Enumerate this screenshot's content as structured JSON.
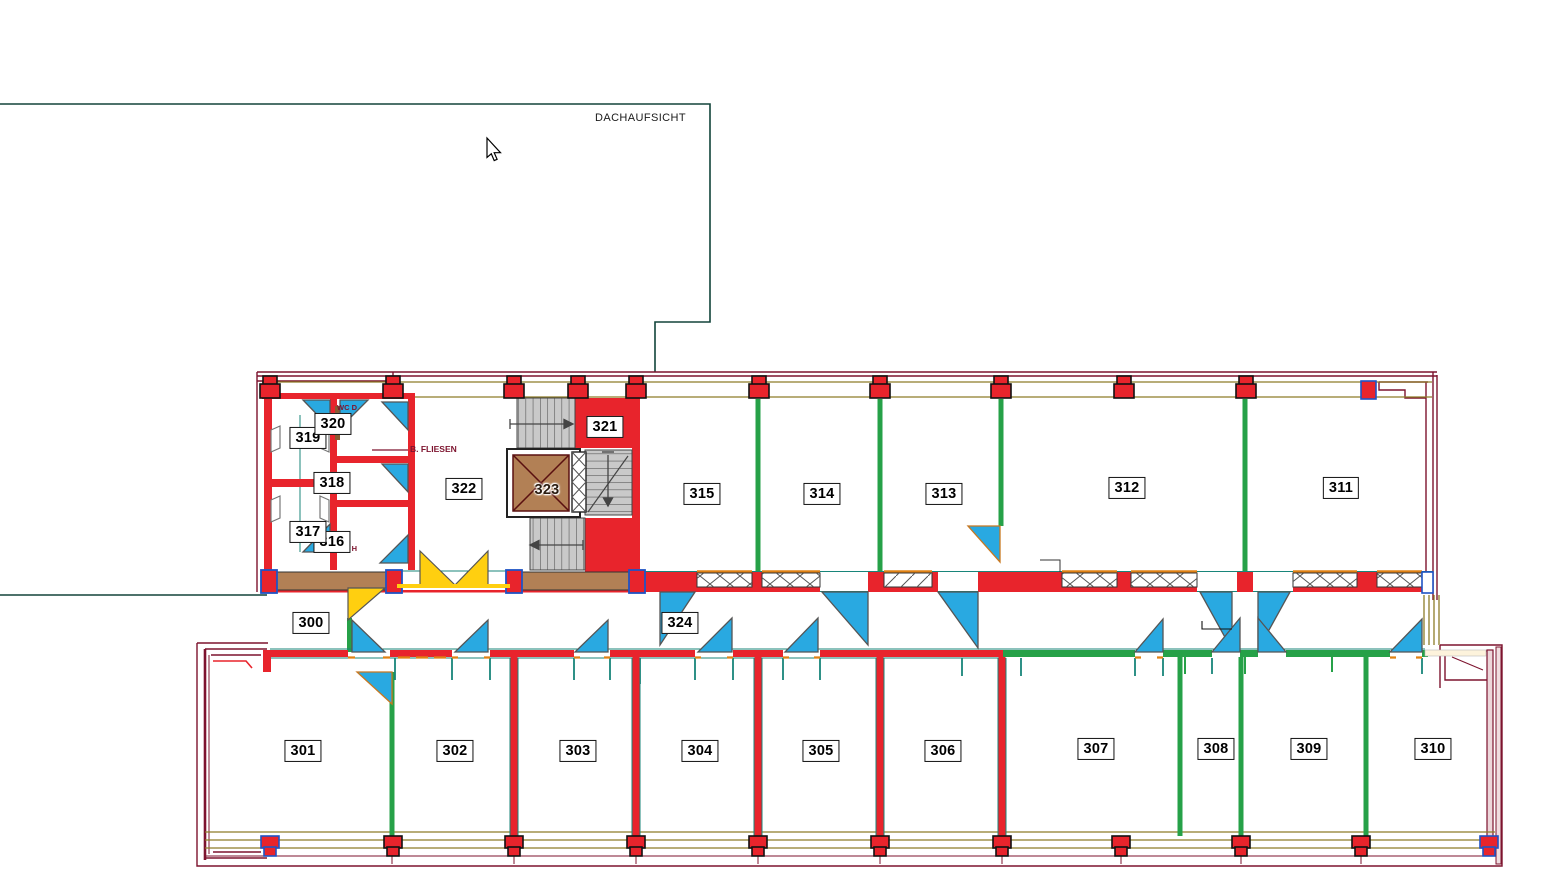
{
  "annotations": {
    "dachaufsicht": "DACHAUFSICHT",
    "wc_d": "WC D",
    "wc_h": "WC H",
    "b_fliesen": "B. FLIESEN"
  },
  "rooms": [
    {
      "id": "room-300",
      "label": "300"
    },
    {
      "id": "room-301",
      "label": "301"
    },
    {
      "id": "room-302",
      "label": "302"
    },
    {
      "id": "room-303",
      "label": "303"
    },
    {
      "id": "room-304",
      "label": "304"
    },
    {
      "id": "room-305",
      "label": "305"
    },
    {
      "id": "room-306",
      "label": "306"
    },
    {
      "id": "room-307",
      "label": "307"
    },
    {
      "id": "room-308",
      "label": "308"
    },
    {
      "id": "room-309",
      "label": "309"
    },
    {
      "id": "room-310",
      "label": "310"
    },
    {
      "id": "room-311",
      "label": "311"
    },
    {
      "id": "room-312",
      "label": "312"
    },
    {
      "id": "room-313",
      "label": "313"
    },
    {
      "id": "room-314",
      "label": "314"
    },
    {
      "id": "room-315",
      "label": "315"
    },
    {
      "id": "room-316",
      "label": "316"
    },
    {
      "id": "room-317",
      "label": "317"
    },
    {
      "id": "room-318",
      "label": "318"
    },
    {
      "id": "room-319",
      "label": "319"
    },
    {
      "id": "room-320",
      "label": "320"
    },
    {
      "id": "room-321",
      "label": "321"
    },
    {
      "id": "room-322",
      "label": "322"
    },
    {
      "id": "room-323",
      "label": "323"
    },
    {
      "id": "room-324",
      "label": "324"
    }
  ],
  "palette": {
    "wall_red": "#e8242c",
    "partition_green": "#26a148",
    "door_blue": "#29a9e1",
    "accent_yellow": "#ffcf10",
    "balcony_brown": "#b28055",
    "stair_gray": "#c9c9c9",
    "facade_olive": "#8d7c28",
    "roof_outline": "#7d132e",
    "plan_outline": "#12443a",
    "jamb_teal": "#18857a",
    "column_outline_blue": "#1f53c5",
    "door_jamb_orange": "#e08214"
  }
}
